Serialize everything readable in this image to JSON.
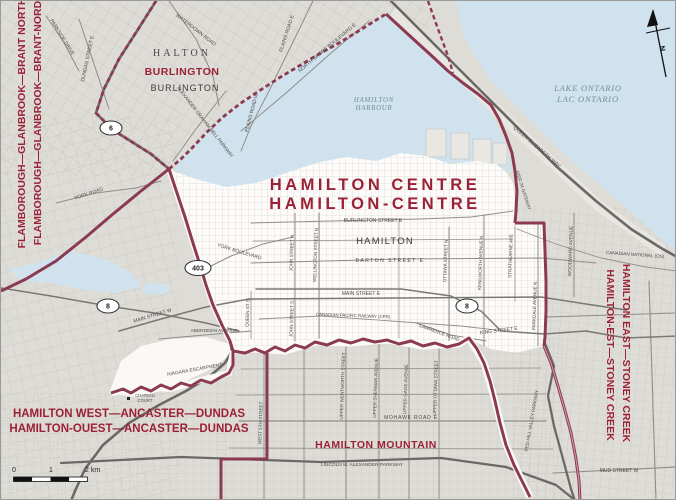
{
  "colors": {
    "district_red_text": "#9b2136",
    "boundary_maroon": "#8c3a54",
    "water": "#cfe2ed",
    "water_text": "#6f8f9c",
    "land": "#dedcd7",
    "district_fill": "#fdfcfa"
  },
  "labels": {
    "title_en": "HAMILTON CENTRE",
    "title_fr": "HAMILTON-CENTRE",
    "flam_en": "FLAMBOROUGH—GLANBROOK—BRANT NORTH",
    "flam_fr": "FLAMBOROUGH—GLANBROOK—BRANT-NORD",
    "hw_en": "HAMILTON WEST—ANCASTER—DUNDAS",
    "hw_fr": "HAMILTON-OUEST—ANCASTER—DUNDAS",
    "he_en": "HAMILTON EAST—STONEY CREEK",
    "he_fr": "HAMILTON-EST—STONEY CREEK",
    "hm": "HAMILTON MOUNTAIN",
    "burlington_district": "BURLINGTON",
    "burlington_city": "BURLINGTON",
    "halton": "HALTON",
    "hamilton_city": "HAMILTON",
    "harbour_1": "HAMILTON",
    "harbour_2": "HARBOUR",
    "lake_en": "LAKE ONTARIO",
    "lake_fr": "LAC ONTARIO",
    "waterdown_rd": "WATERDOWN ROAD",
    "parkside_dr": "PARKSIDE DRIVE",
    "dundas_st": "DUNDAS STREET E",
    "agb_pkwy": "ALEXANDER GRAHAM BELL PARKWAY",
    "north_shore": "NORTH SHORE BOULEVARD E",
    "plains_e": "PLAINS ROAD E",
    "plains_w": "PLAINS ROAD W",
    "york_rd": "YORK ROAD",
    "york_blvd": "YORK BOULEVARD",
    "qew": "QUEEN ELIZABETH WAY",
    "pier24": "PIER 24 GATEWAY",
    "strathearne": "STRATHEARNE AVE",
    "woodward": "WOODWARD AVENUE",
    "cn_rail": "CANADIAN NATIONAL (CN)",
    "cp_rail": "CANADIAN PACIFIC RAILWAY (CPR)",
    "burlington_st": "BURLINGTON STREET E",
    "barton": "BARTON STREET E",
    "main_e": "MAIN STREET E",
    "main_w": "MAIN STREET W",
    "king_e": "KING STREET E",
    "lawrence": "LAWRENCE ROAD",
    "aberdeen": "ABERDEEN AVENUE",
    "john_n": "JOHN STREET N",
    "wellington_n": "WELLINGTON STREET N",
    "ottawa_n": "OTTAWA STREET N",
    "kenilworth_n": "KENILWORTH AVENUE N",
    "parkdale": "PARKDALE AVENUE N",
    "queen_s": "QUEEN ST S",
    "john_s": "JOHN STREET S",
    "west5": "WEST 5TH STREET",
    "up_wentworth": "UPPER WENTWORTH STREET",
    "up_sherman": "UPPER SHERMAN AVENUE",
    "up_gage": "UPPER GAGE AVENUE",
    "up_ottawa": "UPPER OTTAWA STREET",
    "redhill": "RED HILL VALLEY PARKWAY",
    "mohawk": "MOHAWK ROAD E",
    "linc": "LINCOLN M. ALEXANDER PARKWAY",
    "mud": "MUD STREET W",
    "escarpment": "NIAGARA ESCARPMENT",
    "chateau1": "CHATEAU",
    "chateau2": "COURT"
  },
  "shields": {
    "h6": "6",
    "h403": "403",
    "h8": "8"
  },
  "scale": {
    "zero": "0",
    "one": "1",
    "two": "2 km"
  },
  "north": "N"
}
